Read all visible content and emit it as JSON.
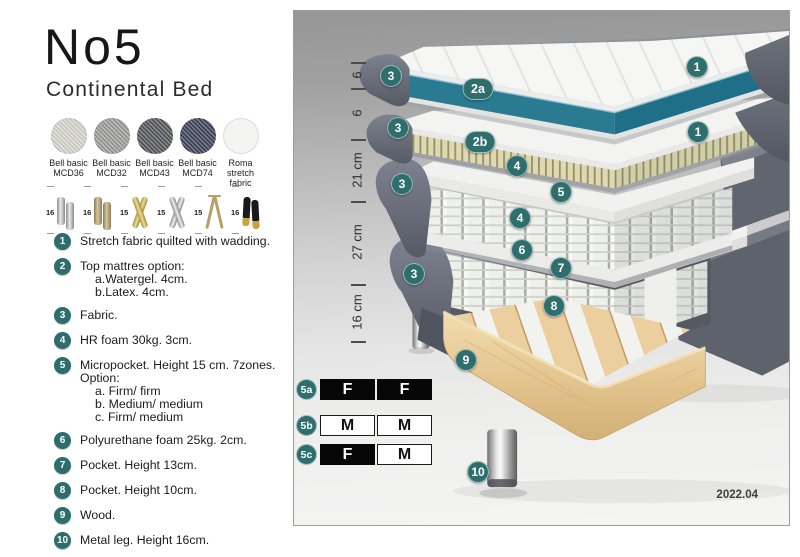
{
  "header": {
    "title": "No5",
    "subtitle": "Continental Bed"
  },
  "swatches": [
    {
      "line1": "Bell basic",
      "line2": "MCD36",
      "color": "#d9d7d0"
    },
    {
      "line1": "Bell basic",
      "line2": "MCD32",
      "color": "#9d9d9b"
    },
    {
      "line1": "Bell basic",
      "line2": "MCD43",
      "color": "#55565a"
    },
    {
      "line1": "Bell basic",
      "line2": "MCD74",
      "color": "#3c4057"
    },
    {
      "line1": "Roma",
      "line2": "stretch fabric",
      "color": "#f4f4f3"
    }
  ],
  "legs": [
    {
      "height": "16",
      "type": "cylinder-silver"
    },
    {
      "height": "16",
      "type": "cylinder-bronze"
    },
    {
      "height": "15",
      "type": "cross-gold"
    },
    {
      "height": "15",
      "type": "cross-silver"
    },
    {
      "height": "15",
      "type": "hairpin"
    },
    {
      "height": "16",
      "type": "black-gold"
    }
  ],
  "list": [
    {
      "num": "1",
      "lines": [
        "Stretch fabric quilted with wadding."
      ]
    },
    {
      "num": "2",
      "lines": [
        "Top mattres option:",
        "a.Watergel. 4cm.",
        "b.Latex. 4cm."
      ]
    },
    {
      "num": "3",
      "lines": [
        "Fabric."
      ]
    },
    {
      "num": "4",
      "lines": [
        "HR foam 30kg. 3cm."
      ]
    },
    {
      "num": "5",
      "lines": [
        "Micropocket. Height 15 cm. 7zones. Option:",
        "a. Firm/ firm",
        "b. Medium/ medium",
        "c. Firm/ medium"
      ]
    },
    {
      "num": "6",
      "lines": [
        "Polyurethane foam 25kg. 2cm."
      ]
    },
    {
      "num": "7",
      "lines": [
        "Pocket. Height 13cm."
      ]
    },
    {
      "num": "8",
      "lines": [
        "Pocket. Height 10cm."
      ]
    },
    {
      "num": "9",
      "lines": [
        "Wood."
      ]
    },
    {
      "num": "10",
      "lines": [
        "Metal leg. Height 16cm."
      ]
    }
  ],
  "diagram": {
    "scale": {
      "ticks_y": [
        51,
        77,
        128,
        190,
        273,
        330
      ],
      "labels": [
        {
          "text": "6",
          "y": 64
        },
        {
          "text": "6",
          "y": 102
        },
        {
          "text": "21 cm",
          "y": 159
        },
        {
          "text": "27 cm",
          "y": 231
        },
        {
          "text": "16 cm",
          "y": 301
        }
      ]
    },
    "callouts": [
      {
        "label": "1",
        "x": 403,
        "y": 56
      },
      {
        "label": "3",
        "x": 97,
        "y": 65
      },
      {
        "label": "2a",
        "x": 184,
        "y": 78,
        "wide": true
      },
      {
        "label": "3",
        "x": 104,
        "y": 117
      },
      {
        "label": "2b",
        "x": 186,
        "y": 131,
        "wide": true
      },
      {
        "label": "1",
        "x": 404,
        "y": 121
      },
      {
        "label": "4",
        "x": 223,
        "y": 155
      },
      {
        "label": "3",
        "x": 108,
        "y": 173
      },
      {
        "label": "5",
        "x": 267,
        "y": 181
      },
      {
        "label": "4",
        "x": 226,
        "y": 207
      },
      {
        "label": "6",
        "x": 228,
        "y": 239
      },
      {
        "label": "7",
        "x": 267,
        "y": 257
      },
      {
        "label": "3",
        "x": 120,
        "y": 263
      },
      {
        "label": "8",
        "x": 260,
        "y": 295
      },
      {
        "label": "9",
        "x": 172,
        "y": 349
      },
      {
        "label": "10",
        "x": 184,
        "y": 461
      }
    ],
    "firmness": [
      {
        "label": "5a",
        "y": 368,
        "cells": [
          {
            "text": "F",
            "variant": "dark"
          },
          {
            "text": "F",
            "variant": "dark"
          }
        ]
      },
      {
        "label": "5b",
        "y": 404,
        "cells": [
          {
            "text": "M",
            "variant": "light"
          },
          {
            "text": "M",
            "variant": "light"
          }
        ]
      },
      {
        "label": "5c",
        "y": 433,
        "cells": [
          {
            "text": "F",
            "variant": "dark"
          },
          {
            "text": "M",
            "variant": "light"
          }
        ]
      }
    ],
    "version": "2022.04"
  },
  "colors": {
    "callout_teal": "#2e6f6e",
    "watergel_teal": "#2a7b92",
    "fabric_gray": "#60646e",
    "latex_beige": "#ded9b2",
    "wood": "#e6c795"
  }
}
